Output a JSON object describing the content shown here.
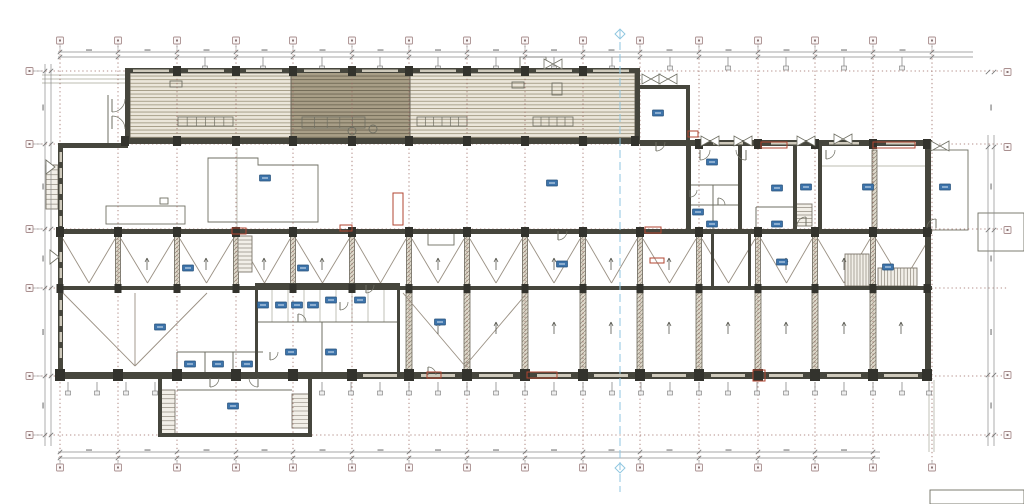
{
  "colors": {
    "wall": "#46463d",
    "wall_dark": "#33332d",
    "wall_mid": "#6b665a",
    "line_mid": "#6f6f63",
    "line_light": "#a6a699",
    "truss": "#9a9083",
    "grid": "#9a6a62",
    "section": "#8fc6e0",
    "dim": "#8a8a8a",
    "window": "#cfcabc",
    "tag": "#3d74ab",
    "tag_border": "#26507a",
    "tag_line": "#dce9f5",
    "red": "#b14531",
    "stair": "#7c766a",
    "hatch_light_bg": "#ebe6da",
    "hatch_light_ln": "#a29a84",
    "hatch_dark_bg": "#a89e87",
    "hatch_dark_ln": "#6f6753",
    "col_bg": "#ded9cb",
    "col_ln": "#8e877a",
    "bubble_border": "#a98f8f",
    "bubble_fill": "#fbf7f7",
    "bubble_dot": "#8a7575"
  },
  "plan": {
    "grid": {
      "v": [
        60,
        118,
        177,
        236,
        293,
        352,
        409,
        467,
        525,
        583,
        640,
        699,
        758,
        815,
        873,
        932
      ],
      "h": [
        71,
        144,
        229,
        288,
        376,
        435
      ]
    },
    "bubbles": {
      "right_ys": [
        72,
        147,
        230,
        375,
        435
      ]
    },
    "section": {
      "x": 620,
      "y1": 30,
      "y2": 492,
      "marker_ys": [
        34,
        468
      ]
    },
    "hatches": [
      [
        130,
        73,
        161,
        65,
        0
      ],
      [
        291,
        70,
        119,
        70,
        1
      ],
      [
        410,
        73,
        225,
        65,
        0
      ]
    ],
    "polys": [
      "208,158 258,158 258,165 318,165 318,222 208,222"
    ],
    "thin_rects": [
      [
        106,
        206,
        79,
        18
      ],
      [
        428,
        233,
        26,
        12
      ],
      [
        520,
        57,
        26,
        13
      ],
      [
        512,
        82,
        12,
        6
      ],
      [
        552,
        83,
        10,
        12
      ],
      [
        170,
        81,
        12,
        6
      ],
      [
        978,
        213,
        46,
        38
      ],
      [
        930,
        490,
        94,
        14
      ],
      [
        930,
        150,
        38,
        80
      ],
      [
        160,
        198,
        8,
        6
      ]
    ],
    "furniture_grids": [
      [
        178,
        117,
        55,
        9,
        6
      ],
      [
        417,
        117,
        50,
        9,
        6
      ],
      [
        533,
        117,
        40,
        9,
        5
      ],
      [
        302,
        117,
        63,
        11,
        5
      ]
    ],
    "lines": [
      [
        42,
        75,
        125,
        75,
        1
      ],
      [
        42,
        79,
        125,
        79,
        1
      ],
      [
        42,
        83,
        125,
        83,
        1
      ],
      [
        108,
        95,
        108,
        143,
        0
      ],
      [
        126,
        95,
        126,
        143,
        0
      ],
      [
        690,
        185,
        738,
        185,
        0
      ],
      [
        690,
        205,
        738,
        205,
        0
      ],
      [
        713,
        185,
        713,
        229,
        0
      ],
      [
        756,
        207,
        793,
        207,
        0
      ],
      [
        756,
        207,
        756,
        229,
        0
      ],
      [
        177,
        352,
        263,
        352,
        0
      ],
      [
        177,
        352,
        177,
        377,
        0
      ],
      [
        205,
        352,
        205,
        377,
        0
      ],
      [
        233,
        352,
        233,
        377,
        0
      ],
      [
        177,
        390,
        292,
        390,
        0
      ],
      [
        272,
        285,
        272,
        322,
        1
      ],
      [
        288,
        285,
        288,
        322,
        1
      ],
      [
        304,
        285,
        304,
        322,
        1
      ],
      [
        320,
        285,
        320,
        322,
        1
      ],
      [
        336,
        285,
        336,
        322,
        1
      ],
      [
        352,
        285,
        352,
        322,
        1
      ],
      [
        368,
        285,
        368,
        322,
        1
      ],
      [
        384,
        285,
        384,
        322,
        1
      ],
      [
        255,
        322,
        397,
        322,
        0
      ],
      [
        322,
        322,
        322,
        372,
        0
      ],
      [
        237,
        148,
        237,
        228,
        1
      ],
      [
        820,
        166,
        925,
        166,
        1
      ],
      [
        929,
        380,
        929,
        452,
        1
      ],
      [
        934,
        380,
        934,
        452,
        1
      ]
    ],
    "columns": [
      [
        115.5,
        234,
        5,
        52
      ],
      [
        174.5,
        234,
        5,
        52
      ],
      [
        233.5,
        234,
        5,
        52
      ],
      [
        290.5,
        234,
        5,
        52
      ],
      [
        349.5,
        234,
        5,
        52
      ],
      [
        406.5,
        234,
        5,
        52
      ],
      [
        464.5,
        234,
        5,
        52
      ],
      [
        522.5,
        234,
        5,
        52
      ],
      [
        580.5,
        234,
        5,
        52
      ],
      [
        637.5,
        234,
        5,
        52
      ],
      [
        696.5,
        234,
        5,
        52
      ],
      [
        755.5,
        234,
        5,
        52
      ],
      [
        812.5,
        234,
        5,
        52
      ],
      [
        870.5,
        234,
        5,
        52
      ],
      [
        406,
        293,
        6,
        79
      ],
      [
        464,
        293,
        6,
        79
      ],
      [
        522,
        293,
        6,
        79
      ],
      [
        580,
        293,
        6,
        79
      ],
      [
        637,
        293,
        6,
        79
      ],
      [
        696,
        293,
        6,
        79
      ],
      [
        755,
        293,
        6,
        79
      ],
      [
        812,
        293,
        6,
        79
      ],
      [
        870,
        293,
        6,
        79
      ],
      [
        872,
        150,
        5,
        78
      ]
    ],
    "truss": {
      "x_min": 60,
      "x_max": 932,
      "y1": 239,
      "y2": 283,
      "extra": [
        [
          63,
          293,
          135,
          366
        ],
        [
          135,
          366,
          207,
          293
        ],
        [
          135,
          293,
          135,
          366
        ],
        [
          403,
          293,
          465,
          366
        ],
        [
          465,
          366,
          527,
          293
        ]
      ]
    },
    "stairs": [
      {
        "x": 238,
        "y": 236,
        "w": 14,
        "h": 36,
        "dir": "h",
        "n": 9
      },
      {
        "x": 878,
        "y": 268,
        "w": 39,
        "h": 18,
        "dir": "v",
        "n": 12
      },
      {
        "x": 160,
        "y": 390,
        "w": 15,
        "h": 44,
        "dir": "h",
        "n": 10
      },
      {
        "x": 292,
        "y": 394,
        "w": 17,
        "h": 34,
        "dir": "h",
        "n": 8
      },
      {
        "x": 46,
        "y": 165,
        "w": 12,
        "h": 44,
        "dir": "h",
        "n": 9
      },
      {
        "x": 796,
        "y": 204,
        "w": 16,
        "h": 22,
        "dir": "h",
        "n": 6
      },
      {
        "x": 845,
        "y": 254,
        "w": 24,
        "h": 32,
        "dir": "v",
        "n": 8
      }
    ],
    "arrows": [
      [
        147,
        258
      ],
      [
        206,
        258
      ],
      [
        264,
        258
      ],
      [
        322,
        258
      ],
      [
        438,
        258
      ],
      [
        496,
        258
      ],
      [
        554,
        258
      ],
      [
        611,
        258
      ],
      [
        669,
        258
      ],
      [
        786,
        258
      ],
      [
        844,
        258
      ],
      [
        438,
        322
      ],
      [
        496,
        322
      ],
      [
        554,
        322
      ],
      [
        611,
        322
      ],
      [
        669,
        322
      ],
      [
        728,
        322
      ],
      [
        786,
        322
      ],
      [
        844,
        322
      ],
      [
        901,
        322
      ]
    ],
    "dims": {
      "chains": [
        [
          58,
          52,
          973,
          52
        ],
        [
          58,
          57,
          973,
          57
        ],
        [
          58,
          452,
          880,
          452
        ],
        [
          58,
          458,
          880,
          458
        ],
        [
          45,
          64,
          45,
          446
        ],
        [
          51,
          64,
          51,
          446
        ],
        [
          988,
          135,
          988,
          446
        ],
        [
          994,
          135,
          994,
          446
        ]
      ]
    },
    "hangers": {
      "top": [
        205,
        263,
        322,
        380,
        438,
        496,
        554,
        612,
        670,
        728,
        786,
        844,
        902
      ],
      "bottom": [
        68,
        97,
        126,
        155,
        322,
        351,
        380,
        409,
        438,
        467,
        496,
        525,
        554,
        583,
        612,
        641,
        670,
        699,
        728,
        757,
        786,
        815,
        844,
        873,
        902,
        929
      ]
    },
    "walls": [
      [
        125,
        68,
        515,
        5
      ],
      [
        125,
        68,
        5,
        75
      ],
      [
        635,
        68,
        5,
        75
      ],
      [
        125,
        138,
        515,
        6
      ],
      [
        640,
        85,
        50,
        4
      ],
      [
        686,
        85,
        4,
        58
      ],
      [
        58,
        143,
        5,
        235
      ],
      [
        58,
        143,
        70,
        5
      ],
      [
        640,
        140,
        292,
        6
      ],
      [
        58,
        229,
        874,
        5
      ],
      [
        58,
        286,
        874,
        4
      ],
      [
        58,
        372,
        874,
        7
      ],
      [
        925,
        146,
        6,
        232
      ],
      [
        686,
        146,
        5,
        85
      ],
      [
        738,
        146,
        4,
        85
      ],
      [
        793,
        146,
        4,
        85
      ],
      [
        818,
        146,
        4,
        85
      ],
      [
        158,
        377,
        4,
        58
      ],
      [
        308,
        377,
        4,
        56
      ],
      [
        158,
        433,
        154,
        4
      ],
      [
        255,
        283,
        3,
        90
      ],
      [
        397,
        283,
        3,
        90
      ],
      [
        255,
        283,
        145,
        3
      ],
      [
        711,
        234,
        3,
        54
      ],
      [
        748,
        234,
        3,
        54
      ]
    ],
    "col_blocks": [
      {
        "y": 66,
        "s": 8,
        "xs": [
          177,
          236,
          293,
          352,
          409,
          467,
          525,
          583
        ]
      },
      {
        "y": 136,
        "s": 8,
        "xs": [
          125,
          177,
          236,
          293,
          352,
          409,
          467,
          525,
          583,
          635
        ]
      },
      {
        "y": 227,
        "s": 8,
        "xs": [
          60,
          118,
          177,
          236,
          293,
          352,
          409,
          467,
          525,
          583,
          640,
          699,
          758,
          815,
          873,
          927
        ]
      },
      {
        "y": 284,
        "s": 7,
        "xs": [
          60,
          118,
          177,
          236,
          293,
          352,
          409,
          467,
          525,
          583,
          640,
          699,
          758,
          815,
          873,
          927
        ]
      },
      {
        "y": 369,
        "s": 10,
        "xs": [
          60,
          118,
          177,
          236,
          293,
          352,
          409,
          467,
          525,
          583,
          640,
          699,
          758,
          815,
          873,
          927
        ]
      },
      {
        "y": 139,
        "s": 8,
        "xs": [
          699,
          758,
          815,
          873,
          927
        ]
      }
    ],
    "win_strips": [
      [
        133,
        69.5,
        36,
        2.5
      ],
      [
        188,
        69.5,
        36,
        2.5
      ],
      [
        246,
        69.5,
        36,
        2.5
      ],
      [
        304,
        69.5,
        36,
        2.5
      ],
      [
        362,
        69.5,
        36,
        2.5
      ],
      [
        420,
        69.5,
        36,
        2.5
      ],
      [
        478,
        69.5,
        36,
        2.5
      ],
      [
        536,
        69.5,
        36,
        2.5
      ],
      [
        593,
        69.5,
        36,
        2.5
      ],
      [
        363,
        374,
        34,
        3
      ],
      [
        421,
        374,
        34,
        3
      ],
      [
        479,
        374,
        34,
        3
      ],
      [
        537,
        374,
        34,
        3
      ],
      [
        594,
        374,
        34,
        3
      ],
      [
        652,
        374,
        34,
        3
      ],
      [
        711,
        374,
        34,
        3
      ],
      [
        769,
        374,
        34,
        3
      ],
      [
        827,
        374,
        34,
        3
      ],
      [
        884,
        374,
        34,
        3
      ],
      [
        713,
        142,
        30,
        2.5
      ],
      [
        771,
        142,
        30,
        2.5
      ],
      [
        829,
        142,
        30,
        2.5
      ],
      [
        886,
        142,
        30,
        2.5
      ],
      [
        59.5,
        152,
        2.5,
        10
      ],
      [
        59.5,
        168,
        2.5,
        10
      ],
      [
        59.5,
        184,
        2.5,
        10
      ],
      [
        59.5,
        200,
        2.5,
        10
      ],
      [
        59.5,
        216,
        2.5,
        10
      ],
      [
        59.5,
        252,
        2.5,
        10
      ],
      [
        59.5,
        268,
        2.5,
        10
      ],
      [
        59.5,
        300,
        2.5,
        10
      ],
      [
        59.5,
        316,
        2.5,
        10
      ],
      [
        59.5,
        332,
        2.5,
        10
      ],
      [
        59.5,
        348,
        2.5,
        10
      ]
    ],
    "doors": [
      {
        "cx": 112,
        "cy": 99,
        "r": 13,
        "q": "se"
      },
      {
        "cx": 112,
        "cy": 129,
        "r": 13,
        "q": "ne"
      },
      {
        "cx": 210,
        "cy": 378,
        "r": 9,
        "q": "se"
      },
      {
        "cx": 258,
        "cy": 378,
        "r": 9,
        "q": "sw"
      },
      {
        "cx": 270,
        "cy": 352,
        "r": 8,
        "q": "se"
      },
      {
        "cx": 298,
        "cy": 322,
        "r": 8,
        "q": "ne"
      },
      {
        "cx": 340,
        "cy": 302,
        "r": 8,
        "q": "se"
      },
      {
        "cx": 366,
        "cy": 285,
        "r": 8,
        "q": "se"
      },
      {
        "cx": 700,
        "cy": 150,
        "r": 10,
        "q": "se"
      },
      {
        "cx": 746,
        "cy": 150,
        "r": 10,
        "q": "sw"
      },
      {
        "cx": 806,
        "cy": 226,
        "r": 9,
        "q": "nw"
      },
      {
        "cx": 826,
        "cy": 150,
        "r": 9,
        "q": "se"
      },
      {
        "cx": 936,
        "cy": 228,
        "r": 9,
        "q": "nw"
      },
      {
        "cx": 656,
        "cy": 142,
        "r": 9,
        "q": "se"
      },
      {
        "cx": 558,
        "cy": 231,
        "r": 9,
        "q": "se"
      },
      {
        "cx": 428,
        "cy": 375,
        "r": 8,
        "q": "ne"
      },
      {
        "cx": 690,
        "cy": 190,
        "r": 7,
        "q": "se"
      },
      {
        "cx": 718,
        "cy": 205,
        "r": 7,
        "q": "ne"
      }
    ],
    "butterflies": [
      [
        651,
        79
      ],
      [
        668,
        79
      ],
      [
        553,
        64
      ],
      [
        710,
        141
      ],
      [
        743,
        141
      ],
      [
        806,
        141
      ],
      [
        843,
        139
      ],
      [
        940,
        146
      ]
    ],
    "wedges": [
      [
        46,
        160
      ],
      [
        50,
        250
      ]
    ],
    "circles": [
      [
        352,
        131,
        4
      ],
      [
        373,
        129,
        4
      ]
    ],
    "reds": [
      [
        761,
        142,
        26,
        6
      ],
      [
        873,
        142,
        42,
        6
      ],
      [
        688,
        131,
        10,
        6
      ],
      [
        645,
        227,
        16,
        6
      ],
      [
        427,
        372,
        14,
        6
      ],
      [
        527,
        372,
        30,
        6
      ],
      [
        753,
        370,
        12,
        11
      ],
      [
        393,
        193,
        10,
        32
      ],
      [
        340,
        225,
        12,
        6
      ],
      [
        650,
        258,
        14,
        5
      ],
      [
        232,
        228,
        14,
        6
      ]
    ],
    "tags": [
      [
        265,
        178
      ],
      [
        552,
        183
      ],
      [
        658,
        113
      ],
      [
        712,
        162
      ],
      [
        777,
        188
      ],
      [
        868,
        187
      ],
      [
        945,
        187
      ],
      [
        698,
        212
      ],
      [
        712,
        224
      ],
      [
        777,
        224
      ],
      [
        806,
        187
      ],
      [
        188,
        268
      ],
      [
        303,
        268
      ],
      [
        562,
        264
      ],
      [
        782,
        262
      ],
      [
        888,
        267
      ],
      [
        160,
        327
      ],
      [
        440,
        322
      ],
      [
        233,
        406
      ],
      [
        263,
        305
      ],
      [
        281,
        305
      ],
      [
        297,
        305
      ],
      [
        313,
        305
      ],
      [
        331,
        300
      ],
      [
        360,
        300
      ],
      [
        291,
        352
      ],
      [
        331,
        352
      ],
      [
        190,
        364
      ],
      [
        218,
        364
      ],
      [
        247,
        364
      ]
    ]
  }
}
